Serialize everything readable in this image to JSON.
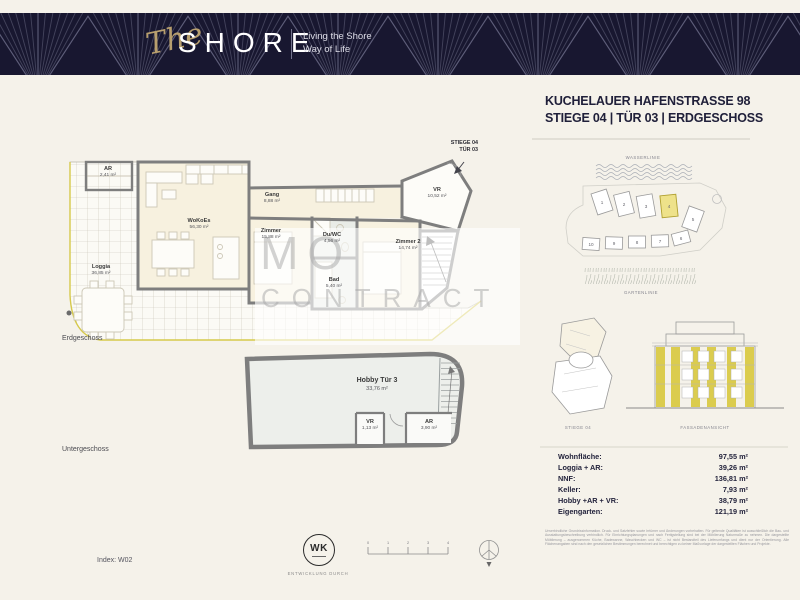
{
  "colors": {
    "banner_navy": "#181730",
    "gold": "#b89f6e",
    "accent_yellow": "#d6c94b",
    "wall_gray": "#7e7e7e",
    "room_cream": "#f7f1df",
    "room_wet": "#e9ece7"
  },
  "header": {
    "logo_script": "The",
    "logo_main": "SHORE",
    "tagline1": "Living the Shore",
    "tagline2": "Way of Life"
  },
  "title": {
    "line1": "KUCHELAUER HAFENSTRASSE 98",
    "line2": "STIEGE 04 | TÜR 03 | ERDGESCHOSS"
  },
  "plan": {
    "stair_label1": "STIEGE 04",
    "stair_label2": "TÜR 03",
    "level_main": "Erdgeschoss",
    "level_basement": "Untergeschoss",
    "rooms": {
      "ar": {
        "name": "AR",
        "area": "2,41 m²"
      },
      "wokoes": {
        "name": "WoKoEs",
        "area": "56,30 m²"
      },
      "gang": {
        "name": "Gang",
        "area": "8,88 m²"
      },
      "zimmer": {
        "name": "Zimmer",
        "area": "15,88 m²"
      },
      "duwc": {
        "name": "Du/WC",
        "area": "4,56 m²"
      },
      "bad": {
        "name": "Bad",
        "area": "5,40 m²"
      },
      "zimmer2": {
        "name": "Zimmer 2",
        "area": "14,74 m²"
      },
      "vr": {
        "name": "VR",
        "area": "10,52 m²"
      },
      "loggia": {
        "name": "Loggia",
        "area": "36,85 m²"
      }
    },
    "basement": {
      "hobby": {
        "name": "Hobby Tür 3",
        "area": "33,76 m²"
      },
      "vr": {
        "name": "VR",
        "area": "1,13 m²"
      },
      "ar": {
        "name": "AR",
        "area": "3,90 m²"
      }
    }
  },
  "watermark": {
    "line1": "IMMO",
    "line2": "CONTRACT"
  },
  "site": {
    "water": "WASSERLINIE",
    "garden": "GARTENLINIE",
    "numbers_top": [
      "1",
      "2",
      "3",
      "4",
      "5"
    ],
    "numbers_bottom": [
      "10",
      "9",
      "8",
      "7",
      "6"
    ]
  },
  "diagrams": {
    "stiege": "STIEGE 04",
    "facade": "FASSADENANSICHT"
  },
  "summary": {
    "rows": [
      {
        "label": "Wohnfläche:",
        "value": "97,55 m²"
      },
      {
        "label": "Loggia + AR:",
        "value": "39,26 m²"
      },
      {
        "label": "NNF:",
        "value": "136,81 m²"
      },
      {
        "label": "Keller:",
        "value": "7,93 m²"
      },
      {
        "label": "Hobby +AR + VR:",
        "value": "38,79 m²"
      },
      {
        "label": "Eigengarten:",
        "value": "121,19 m²"
      }
    ]
  },
  "footer": {
    "index": "Index: W02",
    "logo": "WK",
    "development": "ENTWICKLUNG DURCH",
    "scale": [
      "0",
      "1",
      "2",
      "3",
      "4"
    ],
    "disclaimer": "Unverbindliche Grundrissinformation. Druck- und Satzfehler sowie Irrtümer und Änderungen vorbehalten. Für geltende Qualitäten ist ausschließlich die Bau- und Ausstattungsbeschreibung verbindlich. Für Einrichtungsplanungen und nach Fertigstellung sind bei der Möblierung Naturmaße zu nehmen. Die dargestellte Möblierung – ausgenommen Küche, Badewanne, Waschbecken und WC – ist nicht Bestandteil des Lieferumfangs und dient nur der Orientierung. Alle Flächenangaben sind nach den gesetzlichen Bestimmungen berechnet und berechtigen zu keiner Maßvorlage der dargestellten Flächen und Projekte."
  }
}
